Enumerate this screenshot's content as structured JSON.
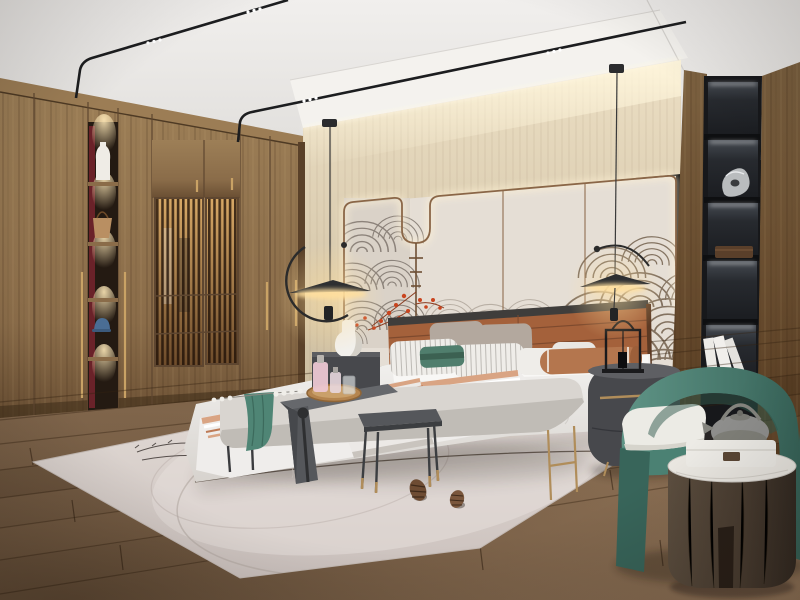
{
  "meta": {
    "type": "interior-photo-recreation",
    "room": "modern Chinese style bedroom, photoreal 3D render, no visible text"
  },
  "palette": {
    "ceiling": "#f1efed",
    "ceiling-dark": "#e0dedb",
    "soffit": "#f6f4f1",
    "cove": "#fdf3d8",
    "wall-beige": "#ddd0b6",
    "wall-beige-dark": "#cbbc9f",
    "wall-panel": "#e5ded5",
    "panel-mural": "#d8d0c7",
    "trim": "#8a6647",
    "mural-gray": "#786f67",
    "mural-mid": "#95897d",
    "mural-brown": "#6b5844",
    "wood": "#8a6c49",
    "wood-dark": "#6b5034",
    "wood-light": "#9d7f57",
    "wood-seam": "#543d26",
    "crown": "#9c7d55",
    "niche-red": "#72242c",
    "niche-dark": "#241a12",
    "gold": "#c9a265",
    "shelf-black": "#17181b",
    "shelf-panel": "#272a2f",
    "floor-a": "#7d6349",
    "floor-b": "#93765a",
    "floor-dark": "#3a2817",
    "rug": "#d8cfca",
    "rug-light": "#e6dfda",
    "rug-line": "#b3a8a2",
    "bed-white": "#f3f2f0",
    "bed-shadow": "#d7d3ce",
    "sheet": "#f8f7f5",
    "leather": "#a4613b",
    "leather-dark": "#7e4a2e",
    "frame-dark": "#3f3d3b",
    "taupe": "#b3a89e",
    "pillow-white": "#efede9",
    "teal-pillow": "#507e6d",
    "bolster": "#b4764e",
    "stripe-a": "#d9a483",
    "stripe-b": "#bd7a55",
    "bench": "#d9d5d0",
    "bench-shade": "#c0bcb6",
    "throw-teal": "#4f8575",
    "dark-table": "#55575b",
    "copper": "#b08d5a",
    "tray-wood": "#b5854f",
    "pink": "#ecc7d2",
    "nightstand": "#47484c",
    "lantern": "#1a1a1c",
    "chair-green": "#4b8173",
    "chair-green-dark": "#38655a",
    "chair-green-light": "#5f9486",
    "cushion-white": "#ecebe5",
    "cyl-wood": "#4a3d31",
    "marble": "#eae7e1",
    "teapot": "#8f8f8d",
    "box-white": "#edebe6",
    "berry": "#c9441e",
    "cone": "#6e4c33",
    "glow": "#ffdf9e",
    "led": "#ffffff"
  },
  "scene": {
    "objects": [
      {
        "name": "ceiling-track-lights",
        "count": 2,
        "detail": "thin black bent tracks with triple LED dot spots"
      },
      {
        "name": "wardrobe",
        "detail": "full-height walnut wardrobe with lattice-slat doors, lit interior, long brass handles"
      },
      {
        "name": "wardrobe-display-niche",
        "shelves": 5,
        "items": [
          "white vase",
          "tan handbag",
          "blue cap"
        ],
        "back_color": "red lacquer"
      },
      {
        "name": "feature-wall",
        "detail": "beige textured band with LED cove, light panels with bronze trim, U drop channel with hanging rod and red berry sprig, wave mural"
      },
      {
        "name": "pendant-lamps",
        "count": 2,
        "detail": "black disc shades on thin wires with curved arms, warm light"
      },
      {
        "name": "bed",
        "detail": "upholstered platform bed, caramel leather channel headboard, white duvet, blush striped quilt"
      },
      {
        "name": "pillows",
        "count": 8,
        "colors": [
          "taupe",
          "white-stripe",
          "teal",
          "rust-bolster"
        ]
      },
      {
        "name": "nightstands",
        "count": 2,
        "detail": "dark oval drawers, bronze pulls; white gourd vase and black candle lantern on top"
      },
      {
        "name": "bench",
        "detail": "light upholstered bench with teal throw and white bead garland"
      },
      {
        "name": "saddle-table",
        "detail": "dark waterfall table over bench holding round wood tray, pink perfume bottles, glasses"
      },
      {
        "name": "side-table-square",
        "detail": "dark square tray table, thin copper-tipped legs"
      },
      {
        "name": "pine-cones",
        "count": 2
      },
      {
        "name": "rug",
        "detail": "pale pink-gray rug with thin arc and branch pattern"
      },
      {
        "name": "armchair",
        "detail": "teal-green barrel chair with ivory seat cushion"
      },
      {
        "name": "drum-side-table",
        "detail": "dark oak cylinder, white marble top, gray teapot, white gift box"
      },
      {
        "name": "shelf-column",
        "compartments": 5,
        "detail": "black recessed shelves with LED strips; silver sculpture, wooden box, white books"
      },
      {
        "name": "floor",
        "detail": "rustic oak planks laid diagonally"
      }
    ]
  }
}
